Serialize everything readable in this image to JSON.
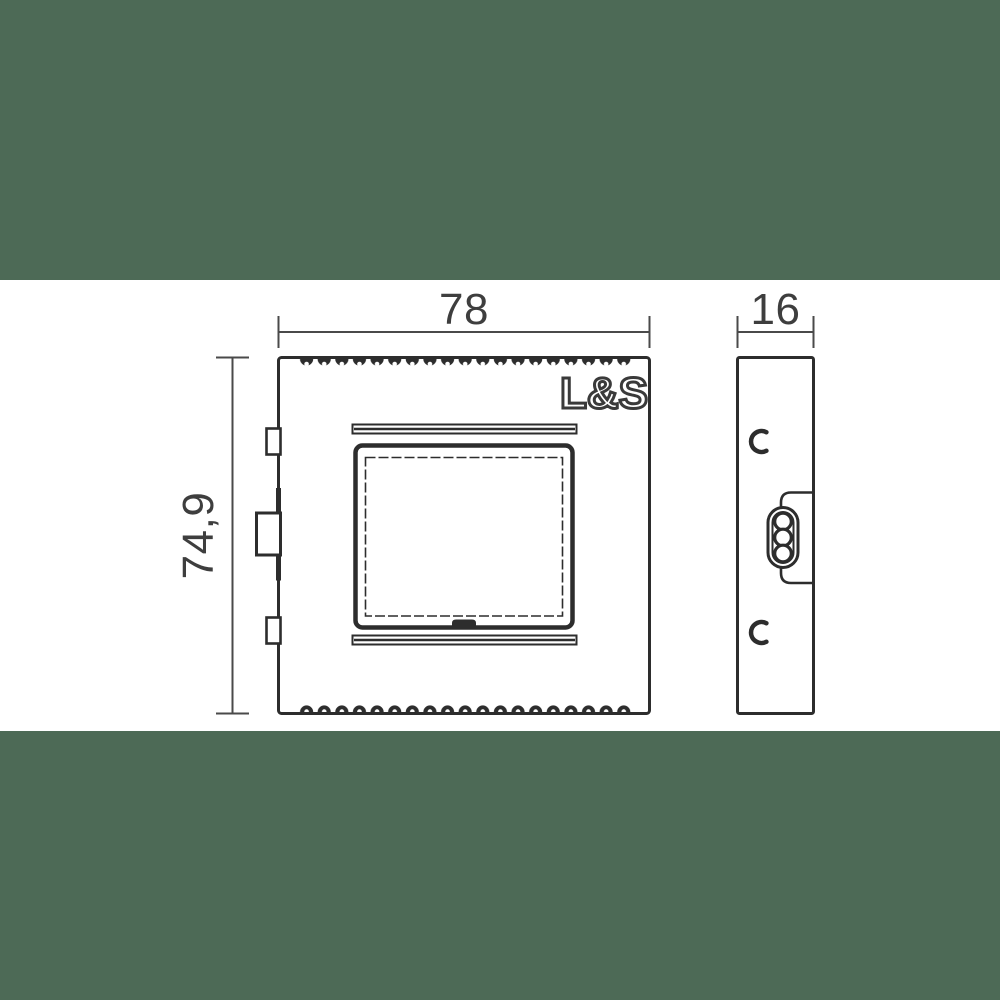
{
  "brand_logo": "L&S",
  "dimension_labels": {
    "width": "78",
    "depth": "16",
    "height": "74,9"
  },
  "colors": {
    "background_band": "#4d6a56",
    "drawing_area": "#ffffff",
    "outline": "#2d2d2d",
    "dimension_line": "#4a4a4a",
    "dimension_text": "#3e3e3e"
  }
}
